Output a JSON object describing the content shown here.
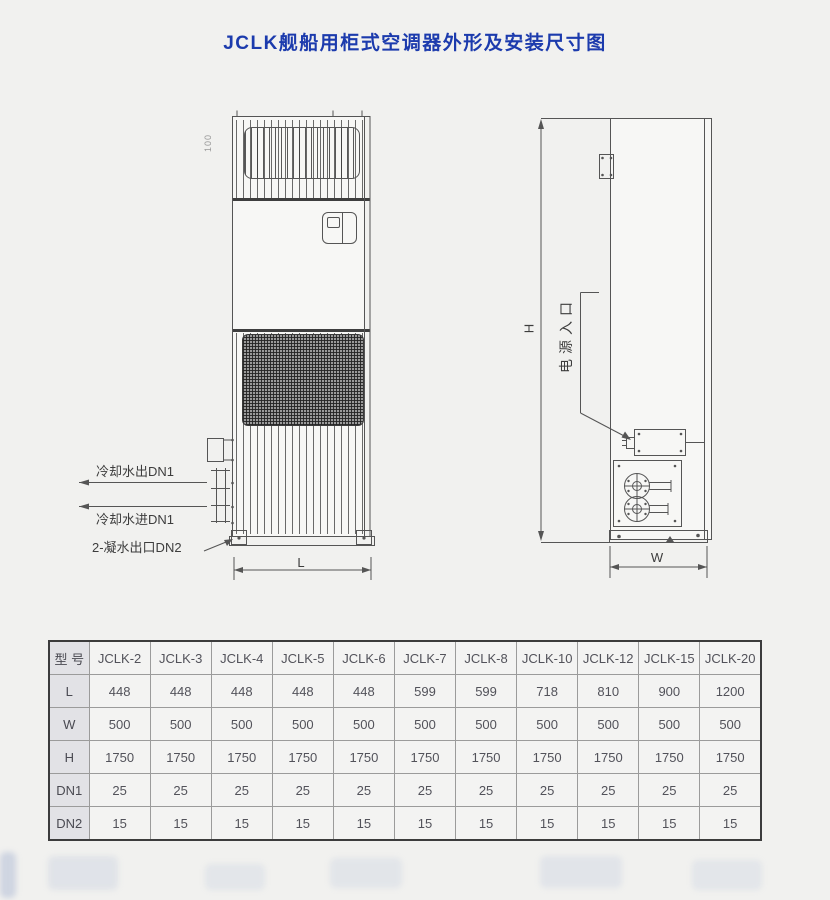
{
  "title": "JCLK舰船用柜式空调器外形及安装尺寸图",
  "front_view": {
    "top_dim_label": "100",
    "dim_length_label": "L",
    "labels": {
      "cooling_water_out": "冷却水出DN1",
      "cooling_water_in": "冷却水进DN1",
      "condensate_out": "2-凝水出口DN2"
    }
  },
  "side_view": {
    "power_inlet_label": "电源入口",
    "dim_height_label": "H",
    "dim_width_label": "W"
  },
  "table": {
    "header_label": "型 号",
    "models": [
      "JCLK-2",
      "JCLK-3",
      "JCLK-4",
      "JCLK-5",
      "JCLK-6",
      "JCLK-7",
      "JCLK-8",
      "JCLK-10",
      "JCLK-12",
      "JCLK-15",
      "JCLK-20"
    ],
    "rows": [
      {
        "label": "L",
        "values": [
          448,
          448,
          448,
          448,
          448,
          599,
          599,
          718,
          810,
          900,
          1200
        ]
      },
      {
        "label": "W",
        "values": [
          500,
          500,
          500,
          500,
          500,
          500,
          500,
          500,
          500,
          500,
          500
        ]
      },
      {
        "label": "H",
        "values": [
          1750,
          1750,
          1750,
          1750,
          1750,
          1750,
          1750,
          1750,
          1750,
          1750,
          1750
        ]
      },
      {
        "label": "DN1",
        "values": [
          25,
          25,
          25,
          25,
          25,
          25,
          25,
          25,
          25,
          25,
          25
        ]
      },
      {
        "label": "DN2",
        "values": [
          15,
          15,
          15,
          15,
          15,
          15,
          15,
          15,
          15,
          15,
          15
        ]
      }
    ]
  },
  "colors": {
    "title_blue": "#1c3bad",
    "drawing_line": "#555555",
    "table_text": "#52525a",
    "row_label_bg": "#e2e2e6"
  }
}
